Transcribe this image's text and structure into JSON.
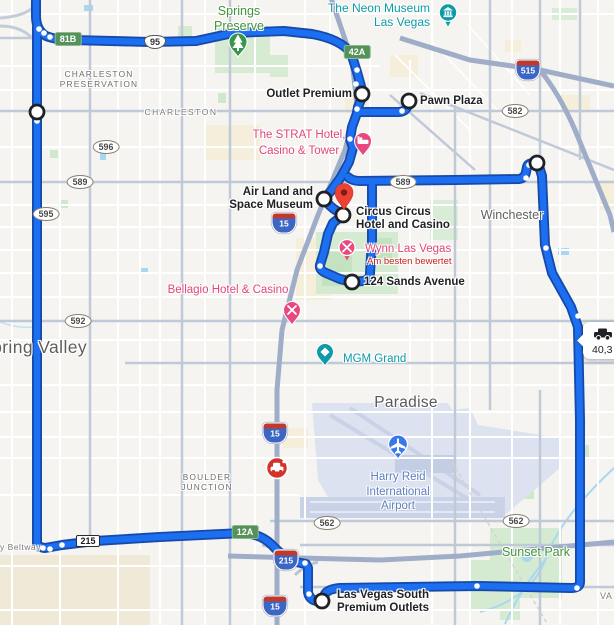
{
  "map": {
    "labels": {
      "springs_preserve": {
        "line1": "Springs",
        "line2": "Preserve"
      },
      "neon_museum": {
        "line1": "The Neon Museum",
        "line2": "Las Vegas"
      },
      "charleston_preservation": {
        "line1": "CHARLESTON",
        "line2": "PRESERVATION"
      },
      "charleston_road": "CHARLESTON",
      "outlet_premium": "Outlet Premium",
      "pawn_plaza": "Pawn Plaza",
      "strat": {
        "line1": "The STRAT Hotel,",
        "line2": "Casino & Tower"
      },
      "air_land": {
        "line1": "Air Land and",
        "line2": "Space Museum"
      },
      "circus": {
        "line1": "Circus Circus",
        "line2": "Hotel and Casino"
      },
      "winchester": "Winchester",
      "wynn": "Wynn Las Vegas",
      "wynn_rating": "Am besten bewertet",
      "sands": "124 Sands Avenue",
      "bellagio": "Bellagio Hotel & Casino",
      "spring_valley": "Spring Valley",
      "mgm": "MGM Grand",
      "paradise": "Paradise",
      "airport": {
        "line1": "Harry Reid",
        "line2": "International",
        "line3": "Airport"
      },
      "boulder_junction": {
        "line1": "BOULDER",
        "line2": "JUNCTION"
      },
      "sunset_park": "Sunset Park",
      "lv_south": {
        "line1": "Las Vegas South",
        "line2": "Premium Outlets"
      },
      "beltway_fragment": "y Beltway",
      "road_fragment": "VA"
    },
    "shields": {
      "exit_81b": "81B",
      "us_95": "95",
      "exit_42a": "42A",
      "i_515": "515",
      "sr_582": "582",
      "sr_596": "596",
      "sr_589": "589",
      "sr_595": "595",
      "i_15": "15",
      "sr_592": "592",
      "sr_562": "562",
      "cc_215_rect": "215",
      "exit_12a": "12A",
      "i_215": "215"
    },
    "callout": {
      "distance": "40,3"
    },
    "colors": {
      "route": "#1c6ff0",
      "route_casing": "#1649a8",
      "poi_pink": "#e0467c",
      "poi_teal": "#0d9aa6",
      "park_green_label": "#44923f",
      "airport_label": "#5e7fc1",
      "destination_red": "#EA4335",
      "incident_red": "#d2332a",
      "exit_badge_green": "#55925a"
    }
  }
}
